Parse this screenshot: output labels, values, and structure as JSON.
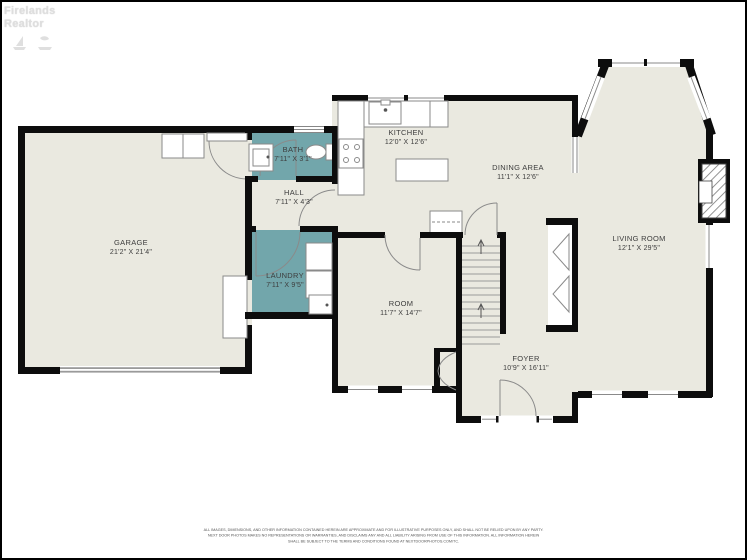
{
  "watermark": {
    "line1": "Firelands",
    "line2": "Realtor"
  },
  "rooms": [
    {
      "id": "garage",
      "name": "GARAGE",
      "dims": "21'2\" X 21'4\""
    },
    {
      "id": "bath",
      "name": "BATH",
      "dims": "7'11\" X 3'1\""
    },
    {
      "id": "hall",
      "name": "HALL",
      "dims": "7'11\" X 4'3\""
    },
    {
      "id": "laundry",
      "name": "LAUNDRY",
      "dims": "7'11\" X 9'5\""
    },
    {
      "id": "kitchen",
      "name": "KITCHEN",
      "dims": "12'0\" X 12'6\""
    },
    {
      "id": "dining",
      "name": "DINING AREA",
      "dims": "11'1\" X 12'6\""
    },
    {
      "id": "living",
      "name": "LIVING ROOM",
      "dims": "12'1\" X 29'5\""
    },
    {
      "id": "room",
      "name": "ROOM",
      "dims": "11'7\" X 14'7\""
    },
    {
      "id": "foyer",
      "name": "FOYER",
      "dims": "10'9\" X 16'11\""
    }
  ],
  "disclaimer": {
    "line1": "ALL IMAGES, DIMENSIONS, AND OTHER INFORMATION CONTAINED HEREIN ARE APPROXIMATE AND FOR ILLUSTRATIVE PURPOSES ONLY, AND SHALL NOT BE RELIED UPON BY ANY PARTY.",
    "line2": "NEXT DOOR PHOTOS MAKES NO REPRESENTATIONS OR WARRANTIES, AND DISCLAIMS ANY AND ALL LIABILITY ARISING FROM USE OF THIS INFORMATION. ALL INFORMATION HEREIN",
    "line3": "SHALL BE SUBJECT TO THE TERMS AND CONDITIONS FOUND AT NEXTDOORPHOTOS.COM/TC."
  },
  "colors": {
    "wall": "#0d0d0d",
    "floor": "#eae9e0",
    "wet_room": "#72a6ab",
    "fixture_line": "#8a8a8a",
    "background": "#ffffff"
  }
}
